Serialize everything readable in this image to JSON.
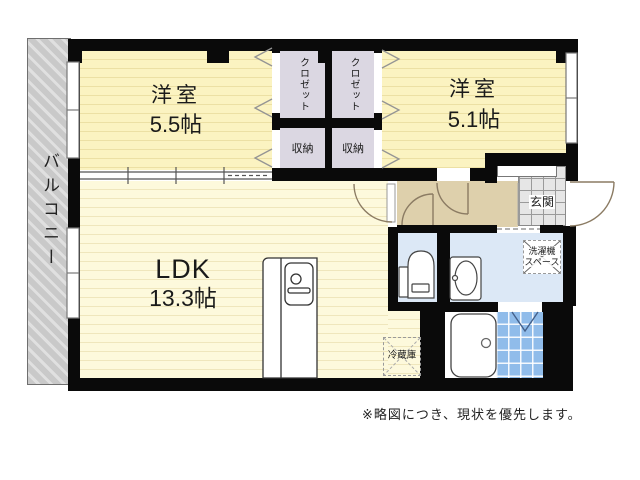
{
  "plan": {
    "balcony_label": "バルコニー",
    "rooms": [
      {
        "name": "洋室",
        "size": "5.5帖"
      },
      {
        "name": "洋室",
        "size": "5.1帖"
      },
      {
        "name": "LDK",
        "size": "13.3帖"
      }
    ],
    "closet_label": "クロゼット",
    "storage_label": "収納",
    "entrance_label": "玄関",
    "washer_label_line1": "洗濯機",
    "washer_label_line2": "スペース",
    "fridge_label": "冷蔵庫",
    "note": "※略図につき、現状を優先します。"
  },
  "colors": {
    "wall": "#0a0a0a",
    "bedroom_floor": "#fbf3c1",
    "ldk_floor": "#fdf9dc",
    "closet": "#dbd7e2",
    "hallway": "#ded0ac",
    "water_rooms": "#dce8f6",
    "bath_tile": "#90bcea",
    "entrance_tile": "#e6e6e6",
    "balcony": "#c9c9c9"
  }
}
